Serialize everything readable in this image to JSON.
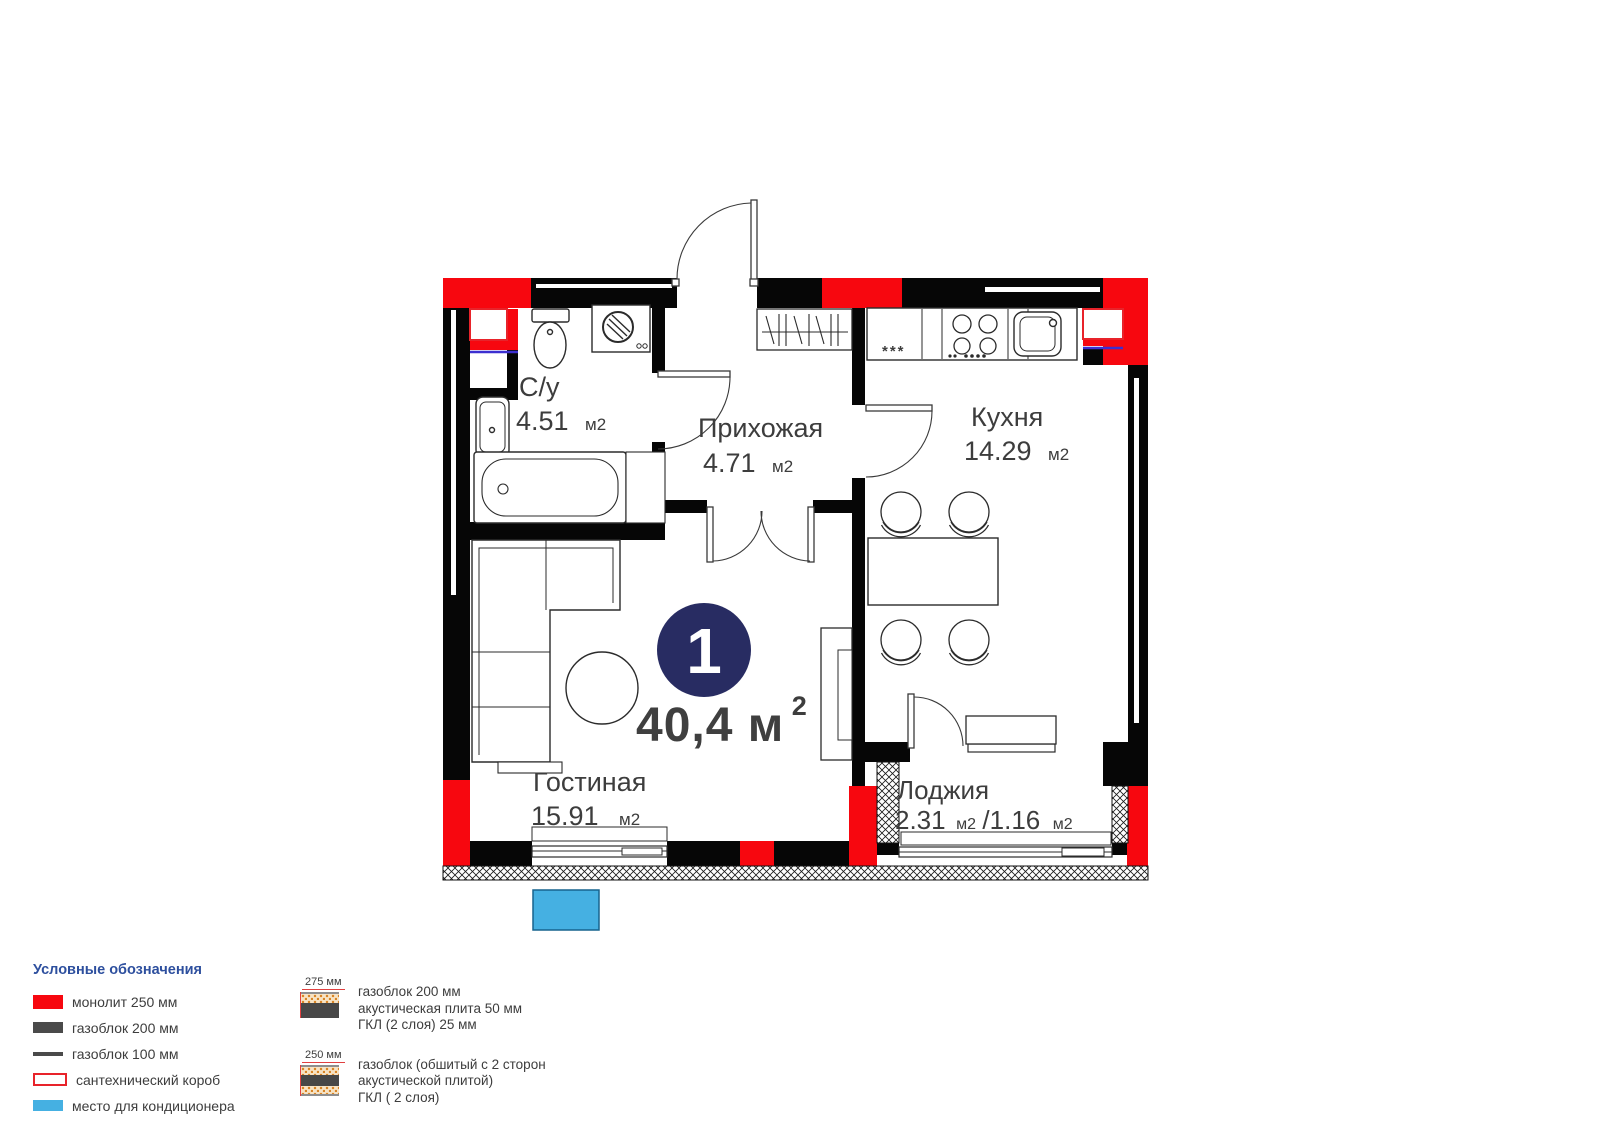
{
  "plan": {
    "unit_number": "1",
    "total_area_main": "40,4 м",
    "total_area_sup": "2",
    "kitchen_freezer_mark": "***",
    "rooms": [
      {
        "label": "С/у",
        "area": "4.51",
        "unit": "м2"
      },
      {
        "label": "Прихожая",
        "area": "4.71",
        "unit": "м2"
      },
      {
        "label": "Кухня",
        "area": "14.29",
        "unit": "м2"
      },
      {
        "label": "Гостиная",
        "area": "15.91",
        "unit": "м2"
      },
      {
        "label": "Лоджия",
        "area": "2.31",
        "unit": "м2",
        "area2": "/1.16",
        "unit2": "м2"
      }
    ]
  },
  "legend": {
    "title": "Условные обозначения",
    "items": [
      {
        "name": "monolith",
        "label": "монолит 250 мм",
        "color": "#f7070f"
      },
      {
        "name": "gasblock-200",
        "label": "газоблок 200 мм",
        "color": "#4a4a4a"
      },
      {
        "name": "gasblock-100",
        "label": "газоблок 100 мм",
        "color": "#4a4a4a"
      },
      {
        "name": "plumbing-duct",
        "label": "сантехнический короб",
        "color": "#e8232a"
      },
      {
        "name": "ac-place",
        "label": "место для кондиционера",
        "color": "#45b0e2"
      }
    ],
    "wall_types": [
      {
        "dimension": "275 мм",
        "lines": [
          "газоблок 200 мм",
          "акустическая плита 50 мм",
          "ГКЛ (2 слоя) 25 мм"
        ]
      },
      {
        "dimension": "250 мм",
        "lines": [
          "газоблок (обшитый с 2 сторон",
          "акустической плитой)",
          "ГКЛ ( 2 слоя)"
        ]
      }
    ]
  },
  "colors": {
    "monolith_red": "#f7070f",
    "wall_black": "#060606",
    "unit_circle_navy": "#282c62",
    "ac_blue": "#45b0e2",
    "duct_blue_line": "#3c2fd0",
    "legend_title_blue": "#2d4f9e",
    "text_dark": "#3d3d3d"
  }
}
